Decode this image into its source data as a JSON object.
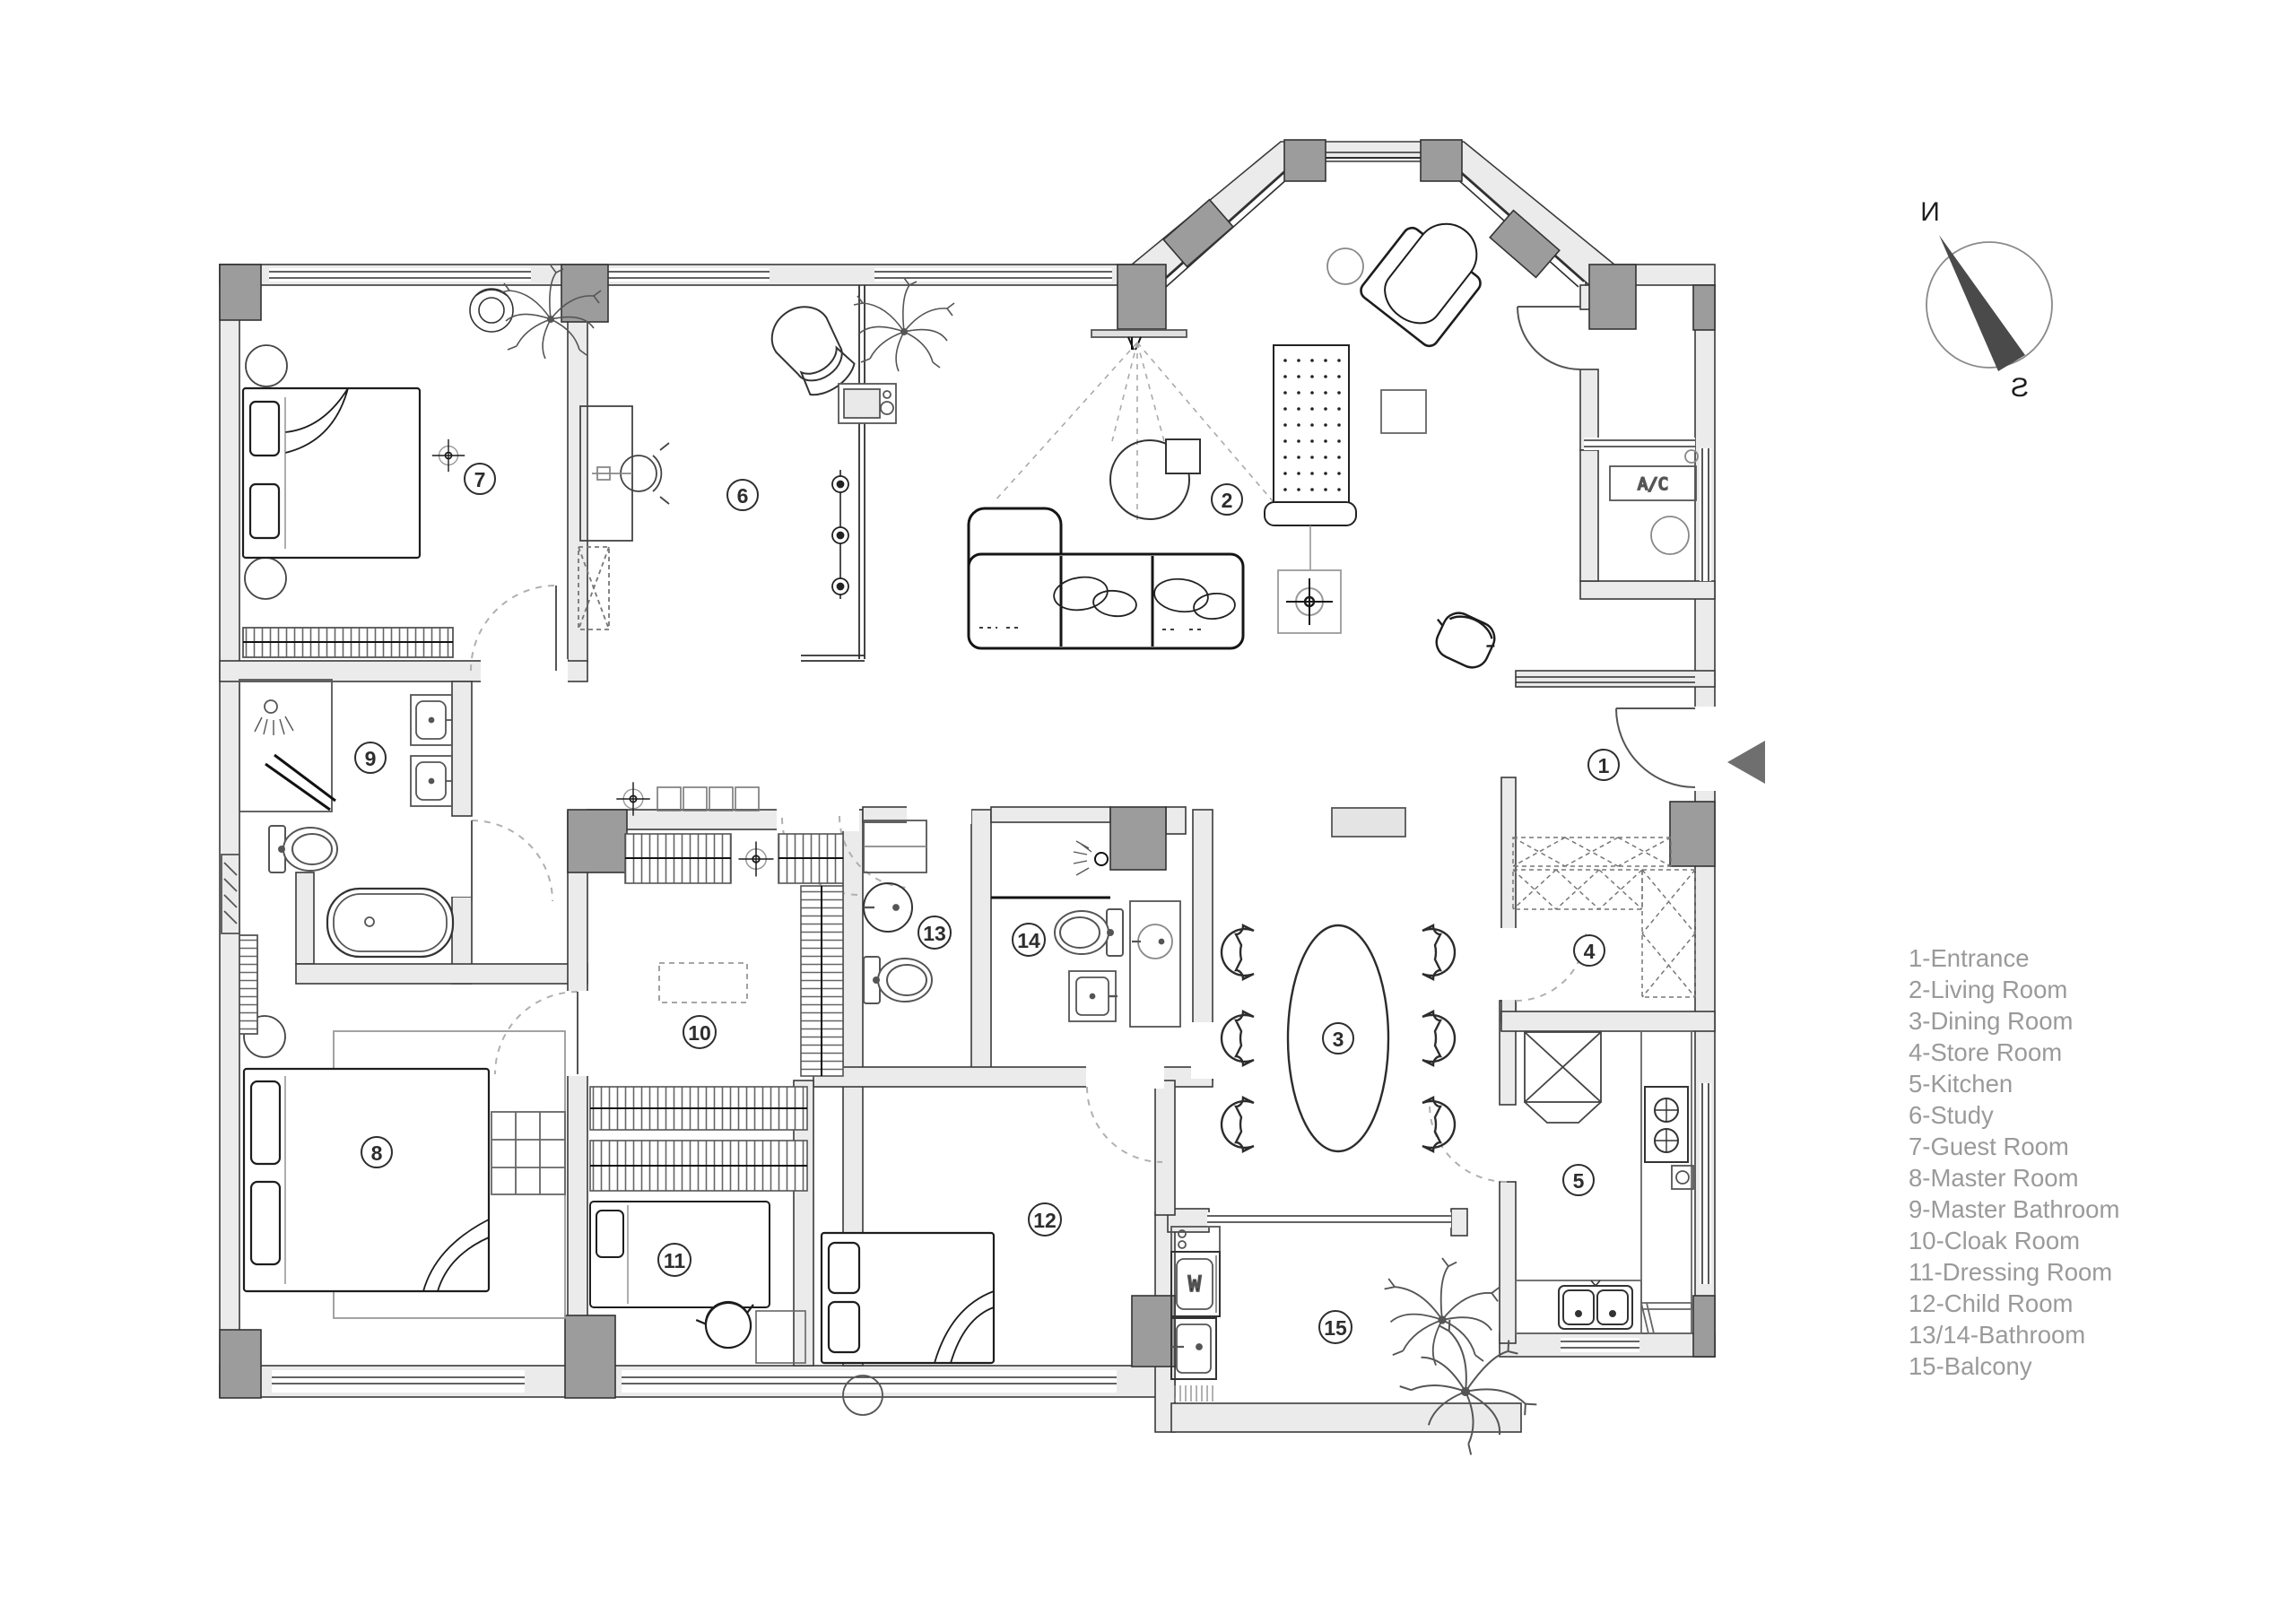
{
  "document": {
    "type": "apartment-floor-plan"
  },
  "compass": {
    "north_label": "N",
    "south_label": "S"
  },
  "ac_unit": {
    "label": "A/C"
  },
  "washer": {
    "label": "W"
  },
  "rooms": [
    {
      "label": "1",
      "name": "entrance"
    },
    {
      "label": "2",
      "name": "living-room"
    },
    {
      "label": "3",
      "name": "dining-room"
    },
    {
      "label": "4",
      "name": "store-room"
    },
    {
      "label": "5",
      "name": "kitchen"
    },
    {
      "label": "6",
      "name": "study"
    },
    {
      "label": "7",
      "name": "guest-room"
    },
    {
      "label": "8",
      "name": "master-room"
    },
    {
      "label": "9",
      "name": "master-bathroom"
    },
    {
      "label": "10",
      "name": "cloak-room"
    },
    {
      "label": "11",
      "name": "dressing-room"
    },
    {
      "label": "12",
      "name": "child-room"
    },
    {
      "label": "13",
      "name": "bathroom-13"
    },
    {
      "label": "14",
      "name": "bathroom-14"
    },
    {
      "label": "15",
      "name": "balcony"
    }
  ],
  "legend": {
    "items": [
      "1-Entrance",
      "2-Living Room",
      "3-Dining Room",
      "4-Store Room",
      "5-Kitchen",
      "6-Study",
      "7-Guest Room",
      "8-Master Room",
      "9-Master Bathroom",
      "10-Cloak Room",
      "11-Dressing Room",
      "12-Child Room",
      "13/14-Bathroom",
      "15-Balcony"
    ]
  },
  "colors": {
    "wall_fill": "#ebebeb",
    "column_fill": "#9c9c9c",
    "line": "#3a3a3a",
    "legend_text": "#9a9a9a",
    "needle": "#4a4a4a"
  }
}
